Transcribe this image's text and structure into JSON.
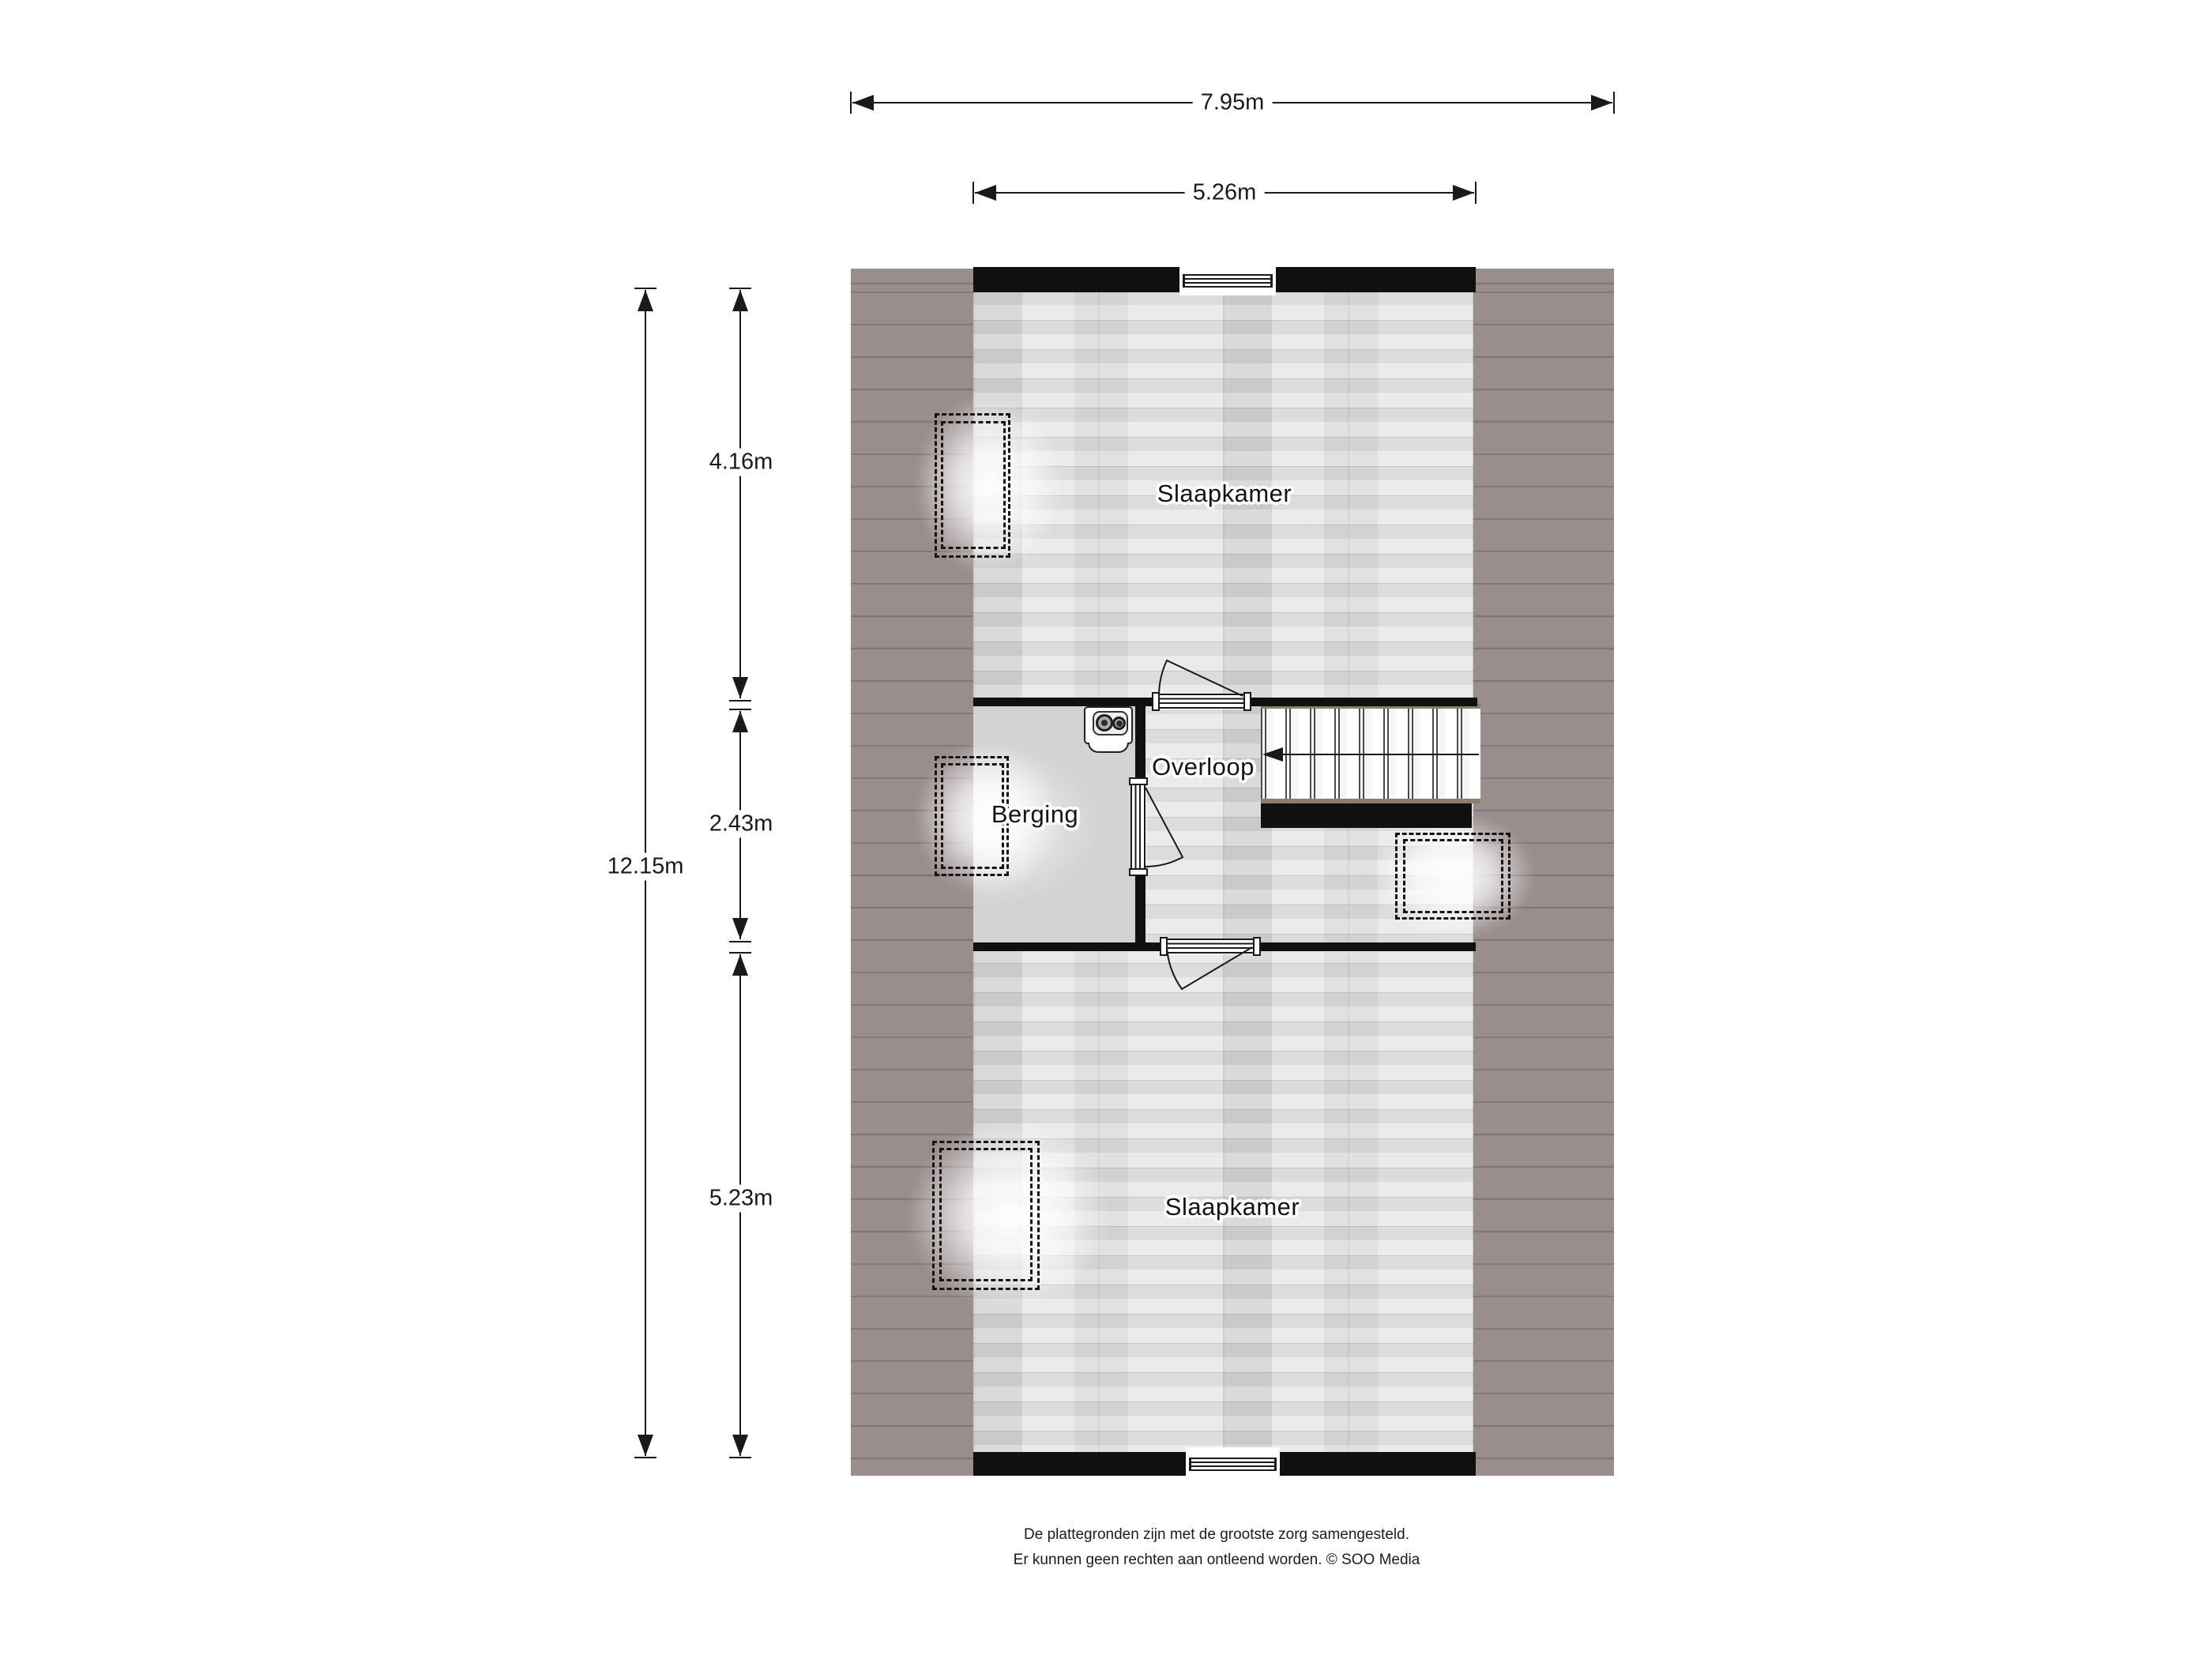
{
  "rooms": {
    "bedroom_top": "Slaapkamer",
    "bedroom_bottom": "Slaapkamer",
    "landing": "Overloop",
    "storage": "Berging"
  },
  "dimensions": {
    "outer_width": "7.95m",
    "inner_width": "5.26m",
    "outer_height": "12.15m",
    "segment_top": "4.16m",
    "segment_middle": "2.43m",
    "segment_bottom": "5.23m"
  },
  "footer": {
    "line1": "De plattegronden zijn met de grootste zorg samengesteld.",
    "line2": "Er kunnen geen rechten aan ontleend worden. © SOO Media"
  },
  "colors": {
    "roof": "#9a8d8d",
    "roof_line": "#827575",
    "wall": "#101010",
    "wood_floor": "#e7e7e7",
    "storage_floor": "#d3d3d3",
    "stair_trim": "#8d7c69",
    "linework": "#1a1a1a"
  }
}
